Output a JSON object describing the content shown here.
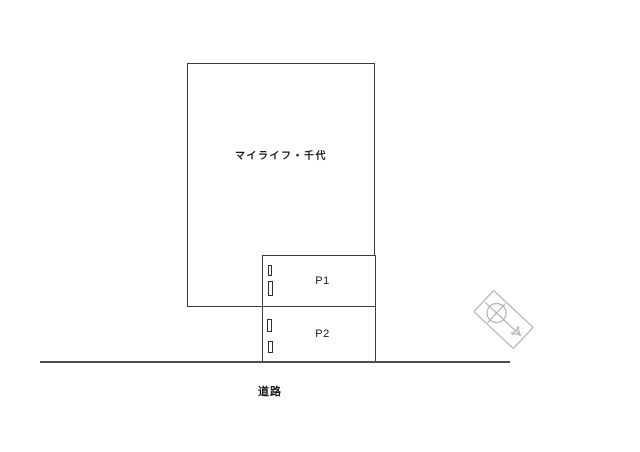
{
  "canvas": {
    "width": 640,
    "height": 452,
    "background": "#ffffff"
  },
  "site_plan": {
    "building": {
      "label": "マイライフ・千代"
    },
    "parking": {
      "spaces": [
        {
          "id": "P1",
          "label": "P1"
        },
        {
          "id": "P2",
          "label": "P2"
        }
      ],
      "wheel_stop_marks_per_space": 2
    },
    "road": {
      "label": "道路"
    },
    "compass": {
      "icon": "north-arrow-icon",
      "arrow_direction": "southeast"
    }
  },
  "colors": {
    "outline": "#3c3c3c",
    "road_line": "#4f4f4f",
    "text": "#1c1c1c",
    "compass_gray": "#b4b4b4",
    "background": "#ffffff"
  }
}
